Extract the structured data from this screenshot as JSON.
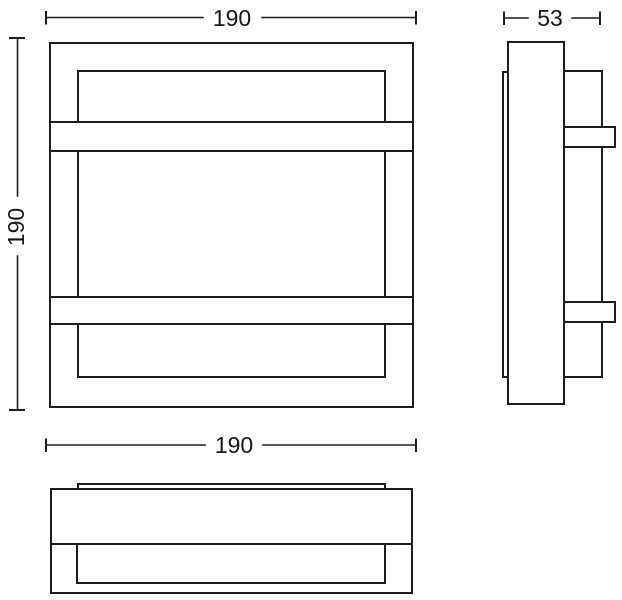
{
  "drawing": {
    "background_color": "#ffffff",
    "line_color": "#1d1d1d",
    "text_color": "#161616",
    "views": {
      "front": {
        "width_label": "190",
        "height_label": "190"
      },
      "side": {
        "depth_label": "53"
      },
      "bottom": {
        "width_label": "190"
      }
    }
  }
}
